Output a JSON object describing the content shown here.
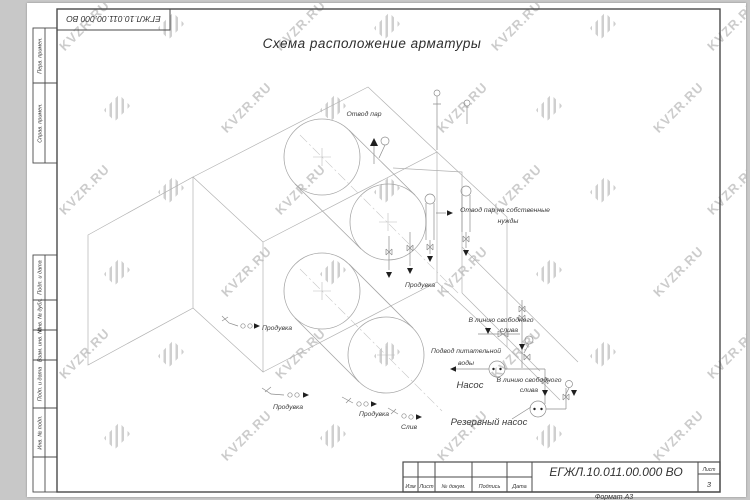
{
  "watermark": {
    "text": "KVZR.RU"
  },
  "title": "Схема расположение арматуры",
  "doc": {
    "designation": "ЕГЖЛ.10.011.00.000 ВО",
    "format": "Формат А3"
  },
  "title_block": {
    "columns": [
      "Изм",
      "Лист",
      "№ докум.",
      "Подпись",
      "Дата"
    ],
    "sheet_label": "Лист",
    "sheet_value": "3"
  },
  "frame": {
    "left_labels": [
      "Перв. примен.",
      "Справ. примен.",
      "Подп. и дата",
      "Инв. № дубл.",
      "Взам. инв. №",
      "Подп. и дата",
      "Инв. № подл."
    ]
  },
  "labels": {
    "steam_out": "Отвод пар",
    "steam_own_1": "Отвод пар на собственные",
    "steam_own_2": "нужды",
    "blowdown": "Продувка",
    "drain": "Слив",
    "free_drain_1": "В линию свободного",
    "free_drain_2": "слива",
    "feedwater_1": "Подвод питательной",
    "feedwater_2": "воды",
    "pump": "Насос",
    "reserve_pump": "Резервный насос"
  }
}
